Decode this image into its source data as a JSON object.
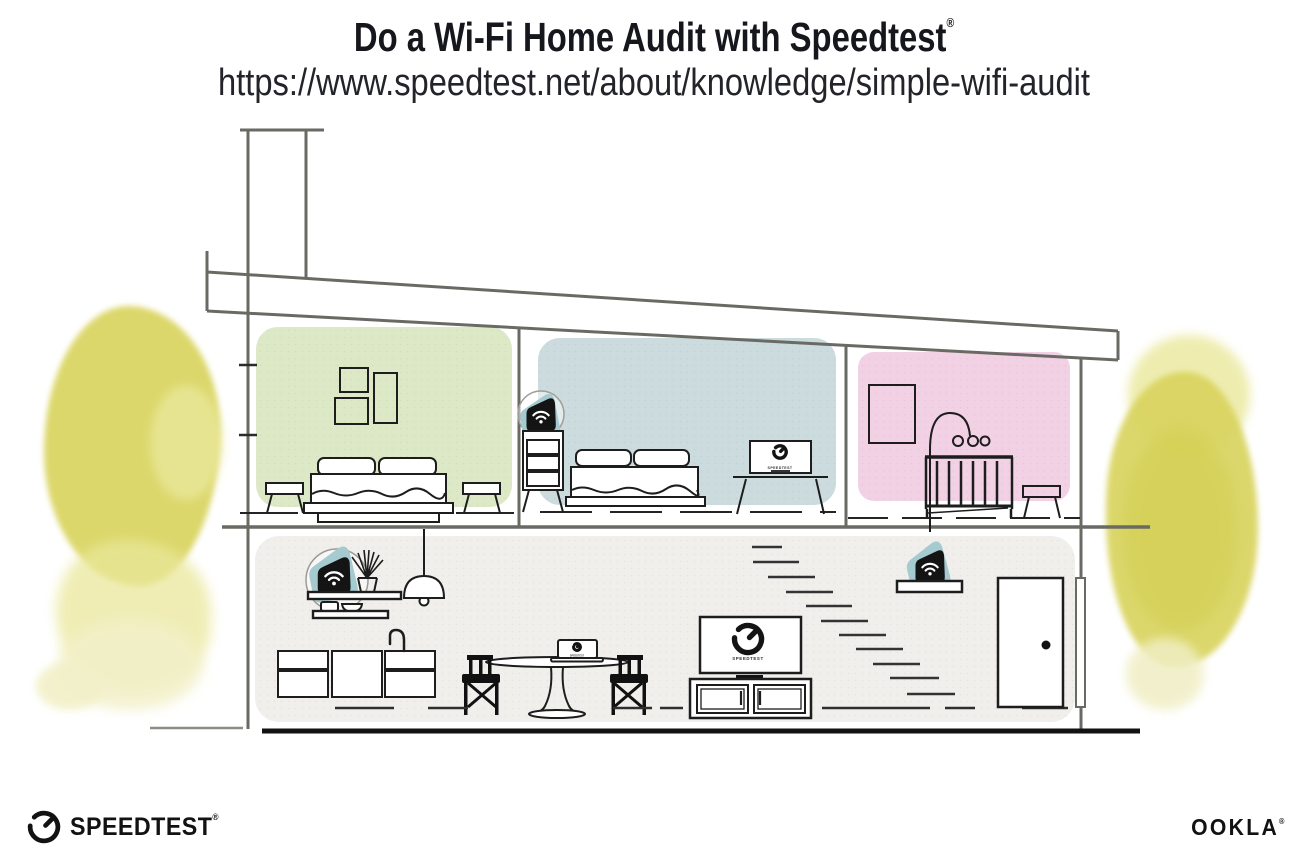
{
  "header": {
    "title": "Do a Wi-Fi Home Audit with Speedtest",
    "title_registered": "®",
    "url": "https://www.speedtest.net/about/knowledge/simple-wifi-audit"
  },
  "footer": {
    "speedtest": {
      "label": "SPEEDTEST",
      "registered": "®"
    },
    "ookla": {
      "label": "OOKLA",
      "registered": "®"
    }
  },
  "illustration": {
    "scene": "Cutaway cross-section of a two-story house showing placement of a Wi-Fi router and two mesh points",
    "screen_label": "SPEEDTEST",
    "rooms": {
      "bedroom_left": {
        "name": "bedroom-left",
        "color": "#dde9c6"
      },
      "bedroom_middle": {
        "name": "bedroom-middle",
        "color": "#ccdcde"
      },
      "nursery_right": {
        "name": "nursery-right",
        "color": "#f2d1e5"
      },
      "living_floor": {
        "name": "kitchen-living-floor",
        "color": "#f0efec"
      }
    },
    "colors": {
      "mesh_device_teal": "#a5cad0",
      "device_black": "#141414",
      "wall_gray": "#6a6a64",
      "furniture_line": "#1d1d1d",
      "ground_black": "#121212",
      "tree_yellow": "#d9d45f",
      "tree_yellow_light": "#eae89b",
      "tree_yellow_pale": "#f2f0c8"
    }
  }
}
